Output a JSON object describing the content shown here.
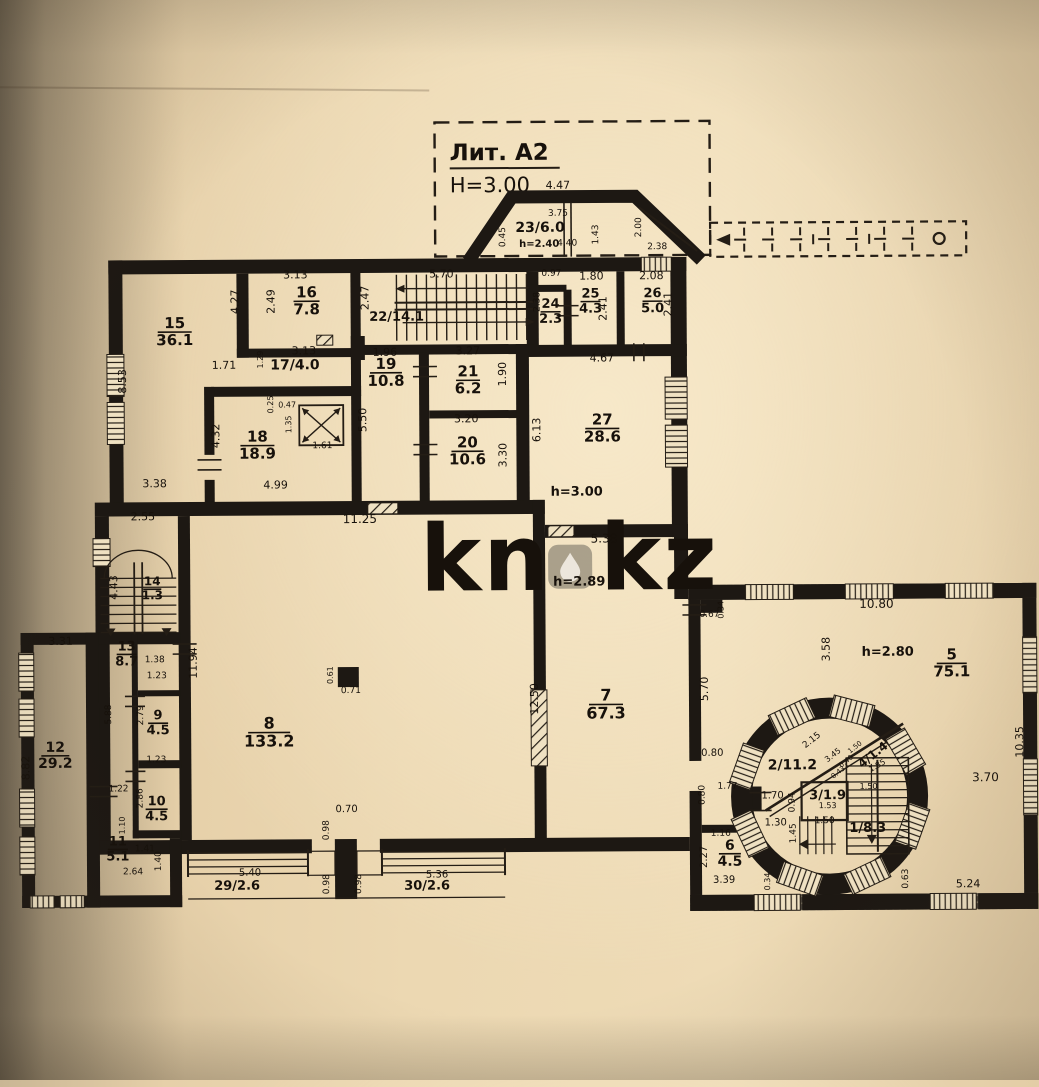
{
  "photo": {
    "watermark": "kn.kz",
    "watermark_left": "kn",
    "watermark_right": "kz"
  },
  "title_block": {
    "liter": "Лит. А2",
    "height": "H=3.00"
  },
  "plan": {
    "ceiling_heights": [
      "h=3.00",
      "h=2.89",
      "h=2.80",
      "h=2.40"
    ],
    "rooms": [
      {
        "number": "1",
        "area": "8.3"
      },
      {
        "number": "2",
        "area": "11.2"
      },
      {
        "number": "3",
        "area": "1.9"
      },
      {
        "number": "4",
        "area": "1.4"
      },
      {
        "number": "5",
        "area": "75.1"
      },
      {
        "number": "6",
        "area": "4.5"
      },
      {
        "number": "7",
        "area": "67.3"
      },
      {
        "number": "8",
        "area": "133.2"
      },
      {
        "number": "9",
        "area": "4.5"
      },
      {
        "number": "10",
        "area": "4.5"
      },
      {
        "number": "11",
        "area": "5.1"
      },
      {
        "number": "12",
        "area": "29.2"
      },
      {
        "number": "13",
        "area": "8.7"
      },
      {
        "number": "14",
        "area": "1.3"
      },
      {
        "number": "15",
        "area": "36.1"
      },
      {
        "number": "16",
        "area": "7.8"
      },
      {
        "number": "17",
        "area": "4.0"
      },
      {
        "number": "18",
        "area": "18.9"
      },
      {
        "number": "19",
        "area": "10.8"
      },
      {
        "number": "20",
        "area": "10.6"
      },
      {
        "number": "21",
        "area": "6.2"
      },
      {
        "number": "22",
        "area": "14.1"
      },
      {
        "number": "23",
        "area": "6.0"
      },
      {
        "number": "24",
        "area": "2.3"
      },
      {
        "number": "25",
        "area": "4.3"
      },
      {
        "number": "26",
        "area": "5.0"
      },
      {
        "number": "27",
        "area": "28.6"
      },
      {
        "number": "29",
        "area": "2.6"
      },
      {
        "number": "30",
        "area": "2.6"
      }
    ]
  },
  "labels": {
    "rooms_frac": [
      [
        "15",
        "36.1",
        176,
        326,
        15,
        34
      ],
      [
        "16",
        "7.8",
        308,
        296,
        15,
        26
      ],
      [
        "18",
        "18.9",
        258,
        440,
        15,
        34
      ],
      [
        "19",
        "10.8",
        387,
        368,
        15,
        32
      ],
      [
        "21",
        "6.2",
        469,
        376,
        15,
        24
      ],
      [
        "20",
        "10.6",
        468,
        447,
        15,
        32
      ],
      [
        "24",
        "2.3",
        552,
        308,
        13,
        20
      ],
      [
        "25",
        "4.3",
        592,
        298,
        13,
        20
      ],
      [
        "26",
        "5.0",
        654,
        298,
        13,
        20
      ],
      [
        "27",
        "28.6",
        603,
        425,
        15,
        34
      ],
      [
        "8",
        "133.2",
        268,
        727,
        16,
        42
      ],
      [
        "7",
        "67.3",
        605,
        701,
        16,
        34
      ],
      [
        "5",
        "75.1",
        951,
        662,
        15,
        30
      ],
      [
        "6",
        "4.5",
        728,
        851,
        14,
        22
      ],
      [
        "9",
        "4.5",
        157,
        717,
        13,
        20
      ],
      [
        "10",
        "4.5",
        155,
        803,
        13,
        22
      ],
      [
        "11",
        "5.1",
        116,
        843,
        13,
        20
      ],
      [
        "12",
        "29.2",
        54,
        749,
        14,
        28
      ],
      [
        "13",
        "8.7",
        126,
        648,
        13,
        20
      ],
      [
        "14",
        "1.3",
        152,
        583,
        12,
        18
      ]
    ],
    "notes": [
      [
        "22/14.1",
        398,
        320,
        13,
        0
      ],
      [
        "17/4.0",
        296,
        368,
        14,
        0
      ],
      [
        "23/6.0",
        542,
        232,
        14,
        0
      ],
      [
        "h=2.40",
        541,
        247,
        10,
        0
      ],
      [
        "2/11.2",
        791,
        771,
        14,
        0
      ],
      [
        "3/1.9",
        826,
        801,
        13,
        0
      ],
      [
        "4/1.4",
        874,
        760,
        12,
        -38
      ],
      [
        "1/8.3",
        866,
        834,
        13,
        0
      ],
      [
        "29/2.6",
        235,
        888,
        13,
        0
      ],
      [
        "30/2.6",
        425,
        889,
        13,
        0
      ],
      [
        "h=3.00",
        577,
        496,
        13,
        0
      ],
      [
        "h=2.89",
        579,
        586,
        13,
        0
      ],
      [
        "h=2.80",
        887,
        658,
        13,
        0
      ]
    ],
    "dims": [
      [
        "4.47",
        560,
        189,
        0,
        11
      ],
      [
        "3.75",
        560,
        216,
        0,
        9
      ],
      [
        "0.45",
        507,
        237,
        -90,
        9
      ],
      [
        "1.43",
        600,
        235,
        -90,
        9
      ],
      [
        "2.00",
        643,
        228,
        -90,
        9
      ],
      [
        "4.40",
        569,
        246,
        0,
        9
      ],
      [
        "2.38",
        659,
        250,
        0,
        9
      ],
      [
        "3.13",
        297,
        277,
        0,
        11
      ],
      [
        "2.49",
        276,
        300,
        -90,
        11
      ],
      [
        "4.27",
        240,
        300,
        -90,
        11
      ],
      [
        "5.70",
        443,
        277,
        0,
        11
      ],
      [
        "2.47",
        370,
        297,
        -90,
        11
      ],
      [
        "0.97",
        553,
        276,
        0,
        9
      ],
      [
        "2.38",
        541,
        302,
        -90,
        9
      ],
      [
        "1.80",
        593,
        280,
        0,
        11
      ],
      [
        "2.41",
        608,
        309,
        -90,
        11
      ],
      [
        "2.08",
        653,
        280,
        0,
        11
      ],
      [
        "2.41",
        673,
        305,
        -90,
        11
      ],
      [
        "1.71",
        225,
        367,
        0,
        11
      ],
      [
        "3.13",
        305,
        353,
        0,
        11
      ],
      [
        "1.29",
        264,
        358,
        -90,
        8
      ],
      [
        "1.96",
        386,
        355,
        0,
        11
      ],
      [
        "8.53",
        127,
        379,
        -90,
        11
      ],
      [
        "3.27",
        469,
        354,
        0,
        11
      ],
      [
        "1.90",
        507,
        374,
        -90,
        11
      ],
      [
        "4.67",
        603,
        362,
        0,
        11
      ],
      [
        "6.13",
        541,
        430,
        -90,
        11
      ],
      [
        "5.50",
        367,
        419,
        -90,
        11
      ],
      [
        "0.25",
        274,
        403,
        -90,
        8
      ],
      [
        "0.47",
        288,
        406,
        0,
        8
      ],
      [
        "1.35",
        292,
        423,
        -90,
        8
      ],
      [
        "1.61",
        323,
        447,
        0,
        9
      ],
      [
        "4.32",
        220,
        434,
        -90,
        11
      ],
      [
        "3.20",
        467,
        422,
        0,
        11
      ],
      [
        "3.30",
        507,
        455,
        -90,
        11
      ],
      [
        "4.99",
        276,
        487,
        0,
        11
      ],
      [
        "3.38",
        155,
        485,
        0,
        11
      ],
      [
        "2.55",
        143,
        518,
        0,
        11
      ],
      [
        "11.25",
        360,
        522,
        0,
        12
      ],
      [
        "5.38",
        604,
        543,
        0,
        12
      ],
      [
        "4.43",
        117,
        585,
        -90,
        11
      ],
      [
        "11.94",
        196,
        661,
        -90,
        11
      ],
      [
        "1.38",
        154,
        660,
        0,
        9
      ],
      [
        "1.23",
        156,
        676,
        0,
        9
      ],
      [
        "3.31",
        60,
        642,
        0,
        11
      ],
      [
        "5.88",
        110,
        712,
        -90,
        9
      ],
      [
        "2.79",
        142,
        713,
        -90,
        9
      ],
      [
        "1.23",
        155,
        760,
        0,
        9
      ],
      [
        "8.82",
        28,
        765,
        -90,
        11
      ],
      [
        "2.86",
        141,
        796,
        -90,
        9
      ],
      [
        "1.22",
        117,
        789,
        0,
        9
      ],
      [
        "1.10",
        123,
        823,
        -90,
        8
      ],
      [
        "1.41",
        143,
        849,
        0,
        9
      ],
      [
        "1.40",
        159,
        859,
        -90,
        9
      ],
      [
        "2.64",
        131,
        872,
        0,
        9
      ],
      [
        "12.50",
        537,
        699,
        -90,
        11
      ],
      [
        "0.61",
        332,
        674,
        -90,
        8
      ],
      [
        "0.71",
        350,
        692,
        0,
        9
      ],
      [
        "0.70",
        345,
        811,
        0,
        10
      ],
      [
        "0.98",
        327,
        829,
        -90,
        9
      ],
      [
        "5.40",
        248,
        874,
        0,
        10
      ],
      [
        "0.98",
        327,
        883,
        -90,
        9
      ],
      [
        "0.98",
        359,
        883,
        -90,
        9
      ],
      [
        "5.36",
        435,
        877,
        0,
        10
      ],
      [
        "0.67",
        709,
        618,
        0,
        9
      ],
      [
        "0.34",
        723,
        611,
        -90,
        8
      ],
      [
        "10.80",
        876,
        610,
        0,
        12
      ],
      [
        "3.58",
        829,
        651,
        -90,
        11
      ],
      [
        "5.70",
        707,
        690,
        -90,
        11
      ],
      [
        "10.35",
        1022,
        745,
        -90,
        11
      ],
      [
        "3.70",
        984,
        784,
        0,
        12
      ],
      [
        "0.80",
        711,
        757,
        0,
        10
      ],
      [
        "0.80",
        703,
        796,
        -90,
        9
      ],
      [
        "1.77",
        726,
        790,
        0,
        9
      ],
      [
        "1.70",
        771,
        800,
        0,
        10
      ],
      [
        "0.94",
        793,
        804,
        -90,
        9
      ],
      [
        "1.30",
        774,
        827,
        0,
        10
      ],
      [
        "1.45",
        794,
        835,
        -90,
        9
      ],
      [
        "1.50",
        823,
        825,
        0,
        9
      ],
      [
        "1.53",
        826,
        810,
        0,
        8
      ],
      [
        "2.15",
        812,
        744,
        -38,
        9
      ],
      [
        "3.45",
        833,
        759,
        -38,
        8
      ],
      [
        "0.40",
        846,
        765,
        -38,
        7
      ],
      [
        "0.43",
        838,
        776,
        -38,
        7
      ],
      [
        "1.50",
        855,
        751,
        -38,
        7
      ],
      [
        "1.85",
        877,
        770,
        -30,
        8
      ],
      [
        "1.50",
        867,
        791,
        0,
        8
      ],
      [
        "1.16",
        719,
        837,
        0,
        9
      ],
      [
        "2.27",
        705,
        858,
        -90,
        10
      ],
      [
        "3.39",
        722,
        884,
        0,
        10
      ],
      [
        "0.34",
        768,
        883,
        -90,
        8
      ],
      [
        "0.63",
        906,
        881,
        -90,
        9
      ],
      [
        "5.24",
        966,
        890,
        0,
        11
      ]
    ]
  }
}
